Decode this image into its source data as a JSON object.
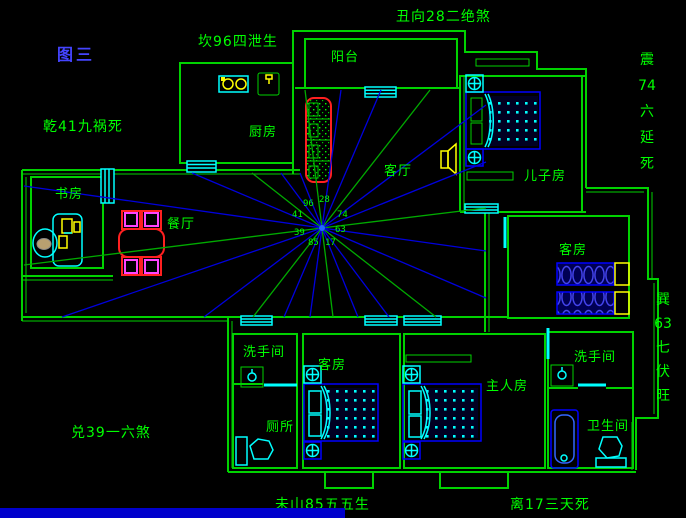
{
  "figure_title": "图三",
  "fengshui_labels": {
    "kan": "坎96四泄生",
    "chou": "丑向28二绝煞",
    "qian": "乾41九祸死",
    "zhen": "震\n74\n六\n延\n死",
    "xun": "巽\n63\n七\n伏\n旺",
    "dui": "兑39一六煞",
    "wei": "未山85五五生",
    "li": "离17三天死"
  },
  "rooms": {
    "balcony": "阳台",
    "kitchen": "厨房",
    "living": "客厅",
    "son": "儿子房",
    "study": "书房",
    "dining": "餐厅",
    "guest_right": "客房",
    "wash1": "洗手间",
    "toilet": "厕所",
    "guest_bottom": "客房",
    "master": "主人房",
    "wash2": "洗手间",
    "bath": "卫生间"
  },
  "compass": {
    "cx": 322,
    "cy": 228,
    "center_numbers": [
      {
        "t": "96",
        "x": 303,
        "y": 199
      },
      {
        "t": "28",
        "x": 319,
        "y": 195
      },
      {
        "t": "41",
        "x": 292,
        "y": 210
      },
      {
        "t": "74",
        "x": 337,
        "y": 210
      },
      {
        "t": "39",
        "x": 294,
        "y": 228
      },
      {
        "t": "63",
        "x": 335,
        "y": 225
      },
      {
        "t": "85",
        "x": 308,
        "y": 238
      },
      {
        "t": "17",
        "x": 325,
        "y": 238
      }
    ],
    "rays": [
      {
        "x": 486,
        "y": 208,
        "c": "g"
      },
      {
        "x": 486,
        "y": 162,
        "c": "b"
      },
      {
        "x": 486,
        "y": 105,
        "c": "b"
      },
      {
        "x": 430,
        "y": 90,
        "c": "g"
      },
      {
        "x": 381,
        "y": 90,
        "c": "b"
      },
      {
        "x": 341,
        "y": 90,
        "c": "b"
      },
      {
        "x": 305,
        "y": 90,
        "c": "g"
      },
      {
        "x": 300,
        "y": 173,
        "c": "b"
      },
      {
        "x": 281,
        "y": 173,
        "c": "b"
      },
      {
        "x": 252,
        "y": 173,
        "c": "g"
      },
      {
        "x": 192,
        "y": 173,
        "c": "b"
      },
      {
        "x": 24,
        "y": 186,
        "c": "b"
      },
      {
        "x": 24,
        "y": 265,
        "c": "g"
      },
      {
        "x": 62,
        "y": 317,
        "c": "b"
      },
      {
        "x": 204,
        "y": 317,
        "c": "b"
      },
      {
        "x": 253,
        "y": 317,
        "c": "g"
      },
      {
        "x": 284,
        "y": 317,
        "c": "b"
      },
      {
        "x": 310,
        "y": 317,
        "c": "b"
      },
      {
        "x": 333,
        "y": 317,
        "c": "g"
      },
      {
        "x": 358,
        "y": 317,
        "c": "b"
      },
      {
        "x": 389,
        "y": 317,
        "c": "b"
      },
      {
        "x": 436,
        "y": 317,
        "c": "g"
      },
      {
        "x": 486,
        "y": 298,
        "c": "b"
      },
      {
        "x": 486,
        "y": 251,
        "c": "b"
      }
    ]
  },
  "colors": {
    "wall": "#00d200",
    "text_green": "#00ff00",
    "title_blue": "#4444ff",
    "ray_blue": "#0000dd",
    "ray_green": "#00aa00",
    "cyan": "#00ffff",
    "red": "#ff2020",
    "magenta": "#ff44ff",
    "yellow": "#ffff00",
    "bed_blue": "#0000ff"
  }
}
